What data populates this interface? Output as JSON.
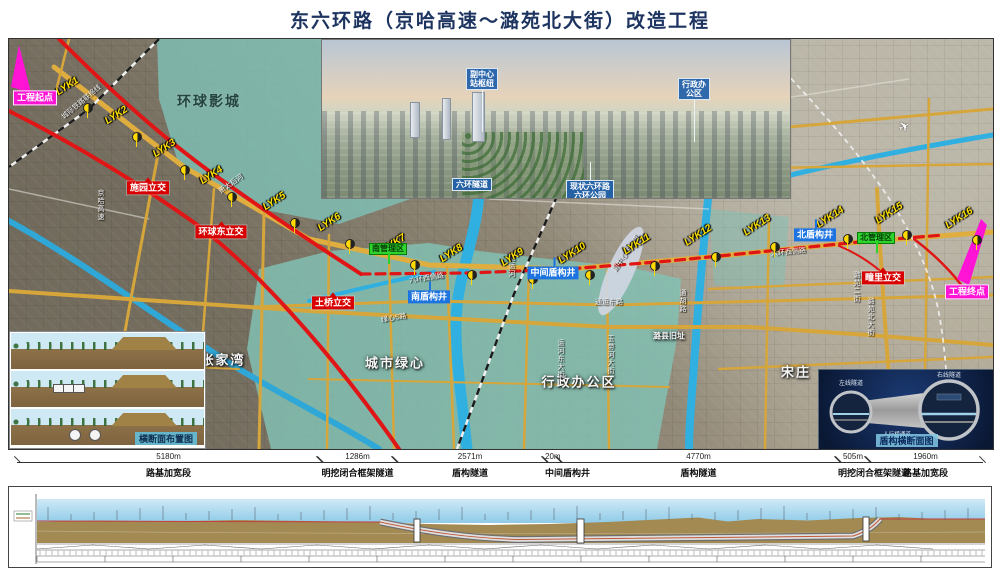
{
  "title": "东六环路（京哈高速～潞苑北大街）改造工程",
  "colors": {
    "title": "#1d3461",
    "red_line": "#e01515",
    "magenta": "#ff14d6",
    "teal_overlay": "#7fc2b8",
    "road_yellow": "#d7a63b",
    "river_blue": "#2fb0e0",
    "label_red": "#d80000",
    "label_blue": "#1d74e0",
    "label_green": "#2ed32e"
  },
  "map": {
    "terminals": [
      {
        "text": "工程起点",
        "x": 26,
        "y": 59
      },
      {
        "text": "工程终点",
        "x": 958,
        "y": 253
      }
    ],
    "milestones": [
      {
        "id": "LYK1",
        "x": 78,
        "y": 68
      },
      {
        "id": "LYK2",
        "x": 127,
        "y": 97
      },
      {
        "id": "LYK3",
        "x": 175,
        "y": 130
      },
      {
        "id": "LYK4",
        "x": 222,
        "y": 157
      },
      {
        "id": "LYK5",
        "x": 285,
        "y": 183
      },
      {
        "id": "LYK6",
        "x": 340,
        "y": 204
      },
      {
        "id": "LYK7",
        "x": 405,
        "y": 225
      },
      {
        "id": "LYK8",
        "x": 462,
        "y": 235
      },
      {
        "id": "LYK9",
        "x": 523,
        "y": 239
      },
      {
        "id": "LYK10",
        "x": 580,
        "y": 235
      },
      {
        "id": "LYK11",
        "x": 645,
        "y": 226
      },
      {
        "id": "LYK12",
        "x": 706,
        "y": 217
      },
      {
        "id": "LYK13",
        "x": 765,
        "y": 207
      },
      {
        "id": "LYK14",
        "x": 838,
        "y": 199
      },
      {
        "id": "LYK15",
        "x": 897,
        "y": 195
      },
      {
        "id": "LYK16",
        "x": 967,
        "y": 200
      }
    ],
    "interchanges": [
      {
        "text": "施园立交",
        "x": 139,
        "y": 149
      },
      {
        "text": "环球东立交",
        "x": 212,
        "y": 193
      },
      {
        "text": "土桥立交",
        "x": 324,
        "y": 264
      },
      {
        "text": "疃里立交",
        "x": 874,
        "y": 239
      }
    ],
    "shafts": [
      {
        "text": "南盾构井",
        "x": 420,
        "y": 258
      },
      {
        "text": "中间盾构井",
        "x": 544,
        "y": 234
      },
      {
        "text": "北盾构井",
        "x": 806,
        "y": 196
      }
    ],
    "zones": [
      {
        "text": "南管理区",
        "x": 379,
        "y": 210
      },
      {
        "text": "北管理区",
        "x": 867,
        "y": 199
      }
    ],
    "areas": [
      {
        "text": "环球影城",
        "x": 200,
        "y": 62,
        "cls": "dark"
      },
      {
        "text": "城市绿心",
        "x": 386,
        "y": 323
      },
      {
        "text": "行政办公区",
        "x": 570,
        "y": 342
      },
      {
        "text": "张家湾",
        "x": 214,
        "y": 320
      },
      {
        "text": "宋庄",
        "x": 787,
        "y": 332
      },
      {
        "text": "潞县旧址",
        "x": 660,
        "y": 297,
        "cls": "sm"
      }
    ],
    "streets": [
      {
        "text": "京哈高速",
        "x": 86,
        "y": 150,
        "v": true
      },
      {
        "text": "城际铁路联络线",
        "x": 48,
        "y": 58,
        "rot": -40
      },
      {
        "text": "萧太后河",
        "x": 208,
        "y": 140,
        "rot": -35
      },
      {
        "text": "北运河",
        "x": 497,
        "y": 215,
        "v": true
      },
      {
        "text": "六环西侧路",
        "x": 400,
        "y": 234,
        "rot": -8
      },
      {
        "text": "六环西侧路",
        "x": 762,
        "y": 208,
        "rot": -6
      },
      {
        "text": "通运东路",
        "x": 586,
        "y": 258
      },
      {
        "text": "运河东大街",
        "x": 546,
        "y": 300,
        "v": true
      },
      {
        "text": "玉带河大街",
        "x": 596,
        "y": 296,
        "v": true
      },
      {
        "text": "潞苑北大街",
        "x": 856,
        "y": 258,
        "v": true
      },
      {
        "text": "绿心S路",
        "x": 372,
        "y": 274,
        "rot": -10
      },
      {
        "text": "通胡路",
        "x": 668,
        "y": 250,
        "v": true
      },
      {
        "text": "潞苑二街",
        "x": 842,
        "y": 232,
        "v": true
      },
      {
        "text": "副中心站枢纽",
        "x": 596,
        "y": 210,
        "rot": -55
      }
    ]
  },
  "render_inset": {
    "labels": [
      {
        "lines": [
          "副中心",
          "站枢纽"
        ],
        "x": 160,
        "y": 28,
        "leader": "down"
      },
      {
        "lines": [
          "行政办",
          "公区"
        ],
        "x": 372,
        "y": 38,
        "leader": "down"
      },
      {
        "lines": [
          "六环隧道"
        ],
        "x": 150,
        "y": 138
      },
      {
        "lines": [
          "现状六环路",
          "六环公园"
        ],
        "x": 268,
        "y": 140,
        "leader": "up"
      }
    ]
  },
  "section_inset": {
    "caption": "横断面布置图"
  },
  "shield_inset": {
    "caption": "盾构横断面图",
    "left_tube": "左线隧道",
    "right_tube": "右线隧道",
    "cross_passage": "人行横通道"
  },
  "scale_bar": {
    "segments": [
      {
        "length_label": "5180m",
        "meters": 5180,
        "name": "路基加宽段"
      },
      {
        "length_label": "1286m",
        "meters": 1286,
        "name": "明挖闭合框架隧道"
      },
      {
        "length_label": "2571m",
        "meters": 2571,
        "name": "盾构隧道"
      },
      {
        "length_label": "20m",
        "meters": 20,
        "name": "中间盾构井"
      },
      {
        "length_label": "4770m",
        "meters": 4770,
        "name": "盾构隧道"
      },
      {
        "length_label": "505m",
        "meters": 505,
        "name": "明挖闭合框架隧道"
      },
      {
        "length_label": "1960m",
        "meters": 1960,
        "name": "路基加宽段"
      }
    ]
  }
}
